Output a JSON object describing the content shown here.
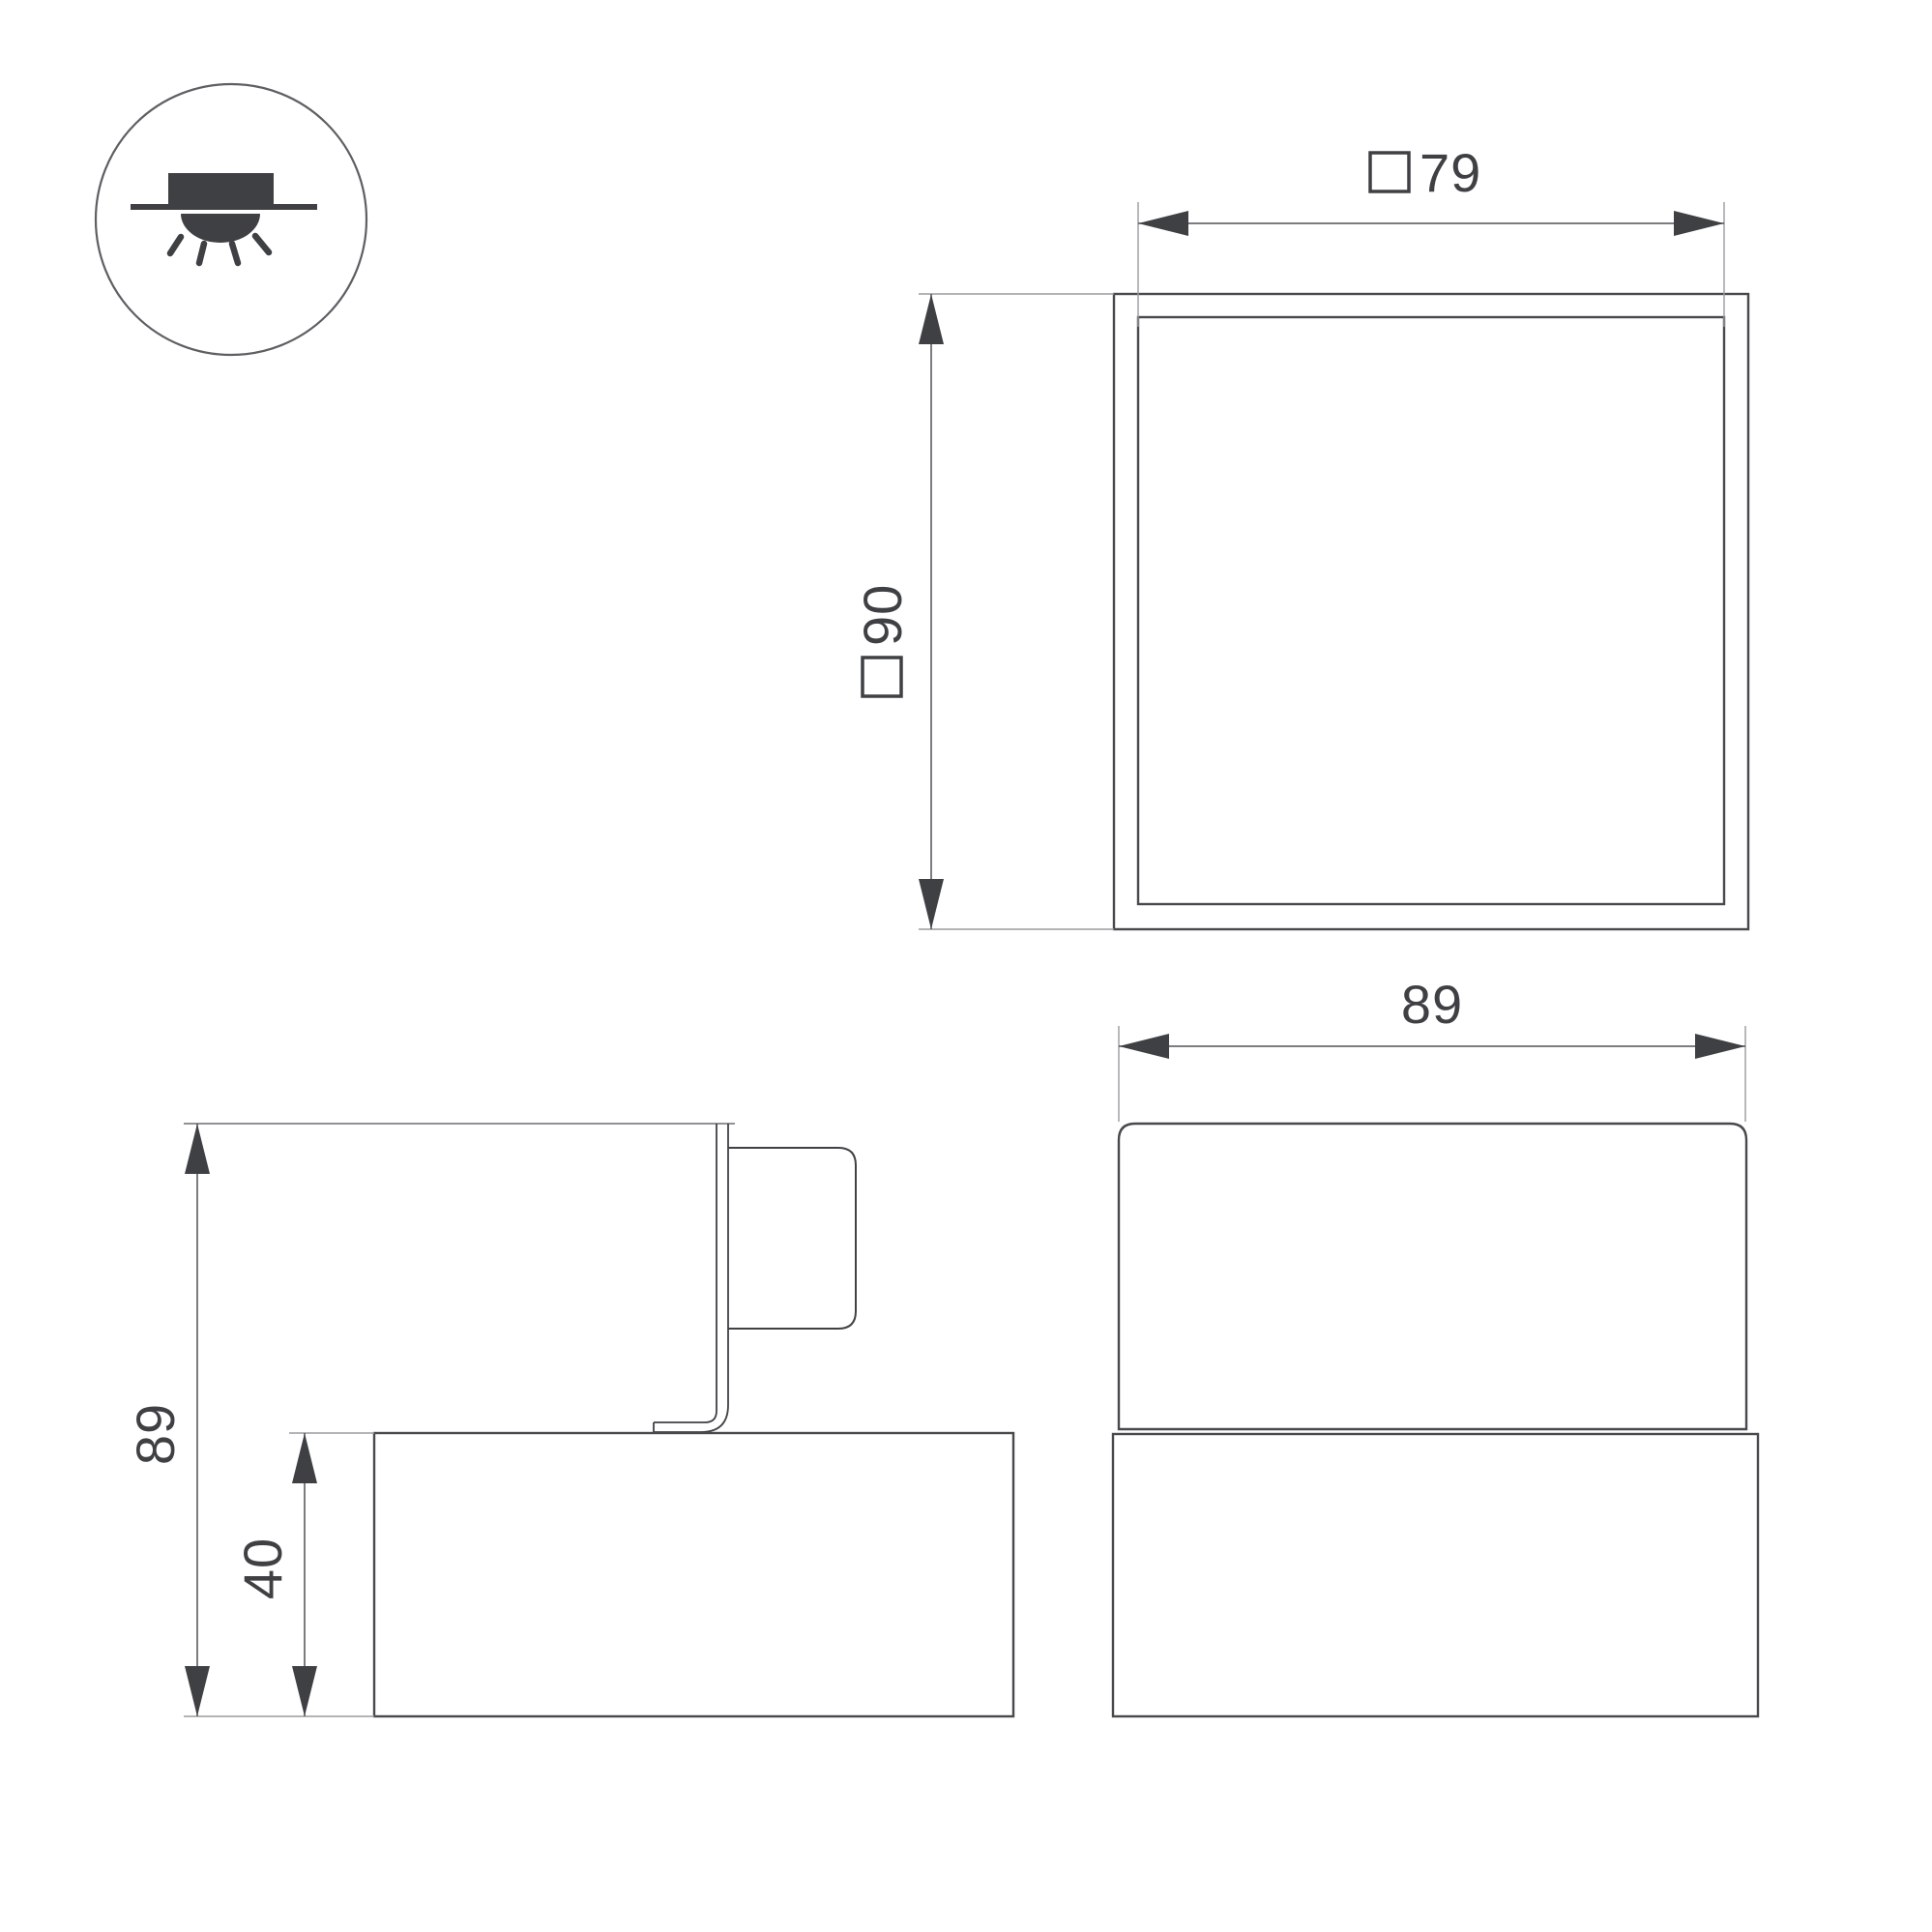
{
  "drawing": {
    "kind": "luminaire-dimension-drawing",
    "background_color": "#ffffff",
    "line_color": "#48494d",
    "accent_text_color": "#3f4044"
  },
  "icon": {
    "name": "surface-downlight-icon",
    "meaning": "surface mounted ceiling light shining downward"
  },
  "dimensions": {
    "front": {
      "square_symbol": "□",
      "panel_size": "79",
      "body_size": "90"
    },
    "side": {
      "total_height": "89",
      "base_height": "40"
    },
    "rear": {
      "body_width": "89"
    }
  }
}
